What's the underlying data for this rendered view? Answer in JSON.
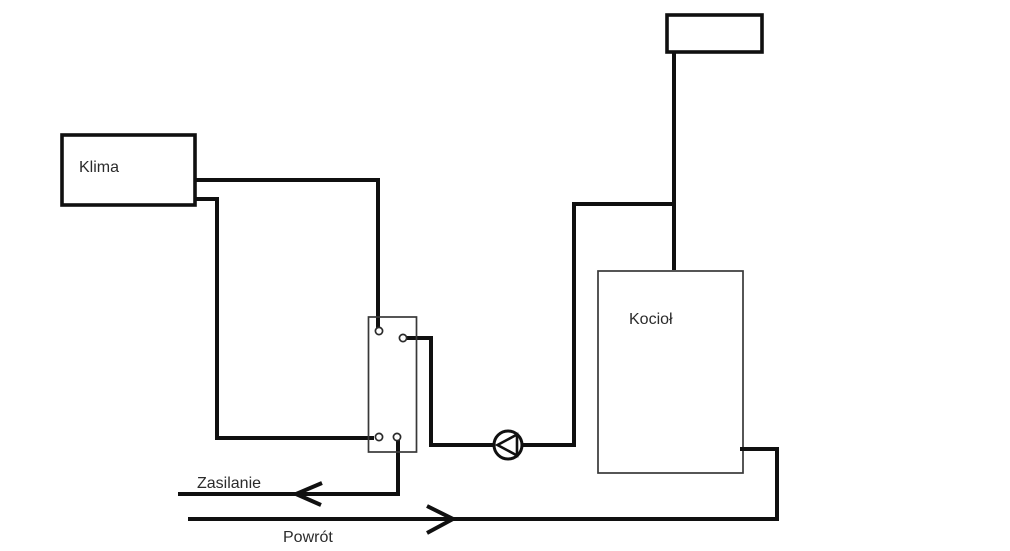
{
  "diagram": {
    "type": "heating-system-schematic",
    "background_color": "#ffffff",
    "pipe_color": "#101010",
    "thin_border_color": "#383838",
    "text_color": "#2b2b2b",
    "boxes": {
      "klima": {
        "label": "Klima"
      },
      "kociol": {
        "label": "Kocioł"
      },
      "top_box": {
        "label": ""
      },
      "junction_box": {
        "label": ""
      }
    },
    "flow_labels": {
      "supply": "Zasilanie",
      "return": "Powrót"
    },
    "icons": {
      "pump": "pump-icon",
      "supply_arrow": "arrow-left-icon",
      "return_arrow": "arrow-right-icon"
    }
  }
}
